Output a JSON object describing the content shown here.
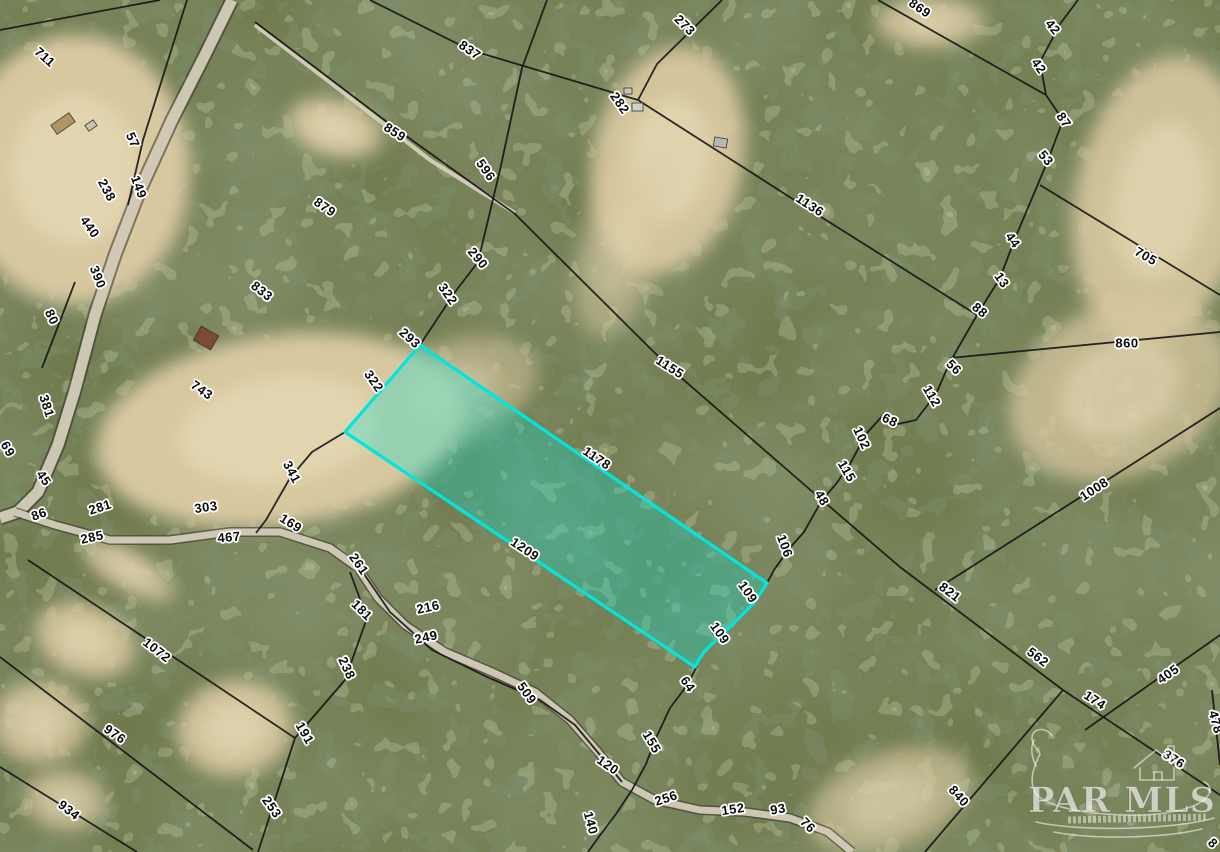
{
  "map": {
    "width": 1220,
    "height": 852,
    "colors": {
      "base": "#6b7547",
      "boundary": "#151515",
      "road": "#d8d0bd",
      "road_casing": "#332f28",
      "clearing": "#d8c8a0",
      "clearing_light": "#e6dab6",
      "parcel_stroke": "#00e6de",
      "parcel_fill": "rgba(0,230,214,0.30)",
      "label_halo": "#ffffff"
    },
    "watermark": {
      "title": "PAR MLS"
    },
    "parcel": {
      "points": [
        [
          420,
          345
        ],
        [
          767,
          583
        ],
        [
          754,
          603
        ],
        [
          733,
          624
        ],
        [
          716,
          640
        ],
        [
          704,
          652
        ],
        [
          698,
          661
        ],
        [
          695,
          667
        ],
        [
          345,
          432
        ]
      ]
    },
    "labels": [
      {
        "t": "711",
        "x": 45,
        "y": 57,
        "r": 42
      },
      {
        "t": "57",
        "x": 133,
        "y": 140,
        "r": 65
      },
      {
        "t": "149",
        "x": 139,
        "y": 187,
        "r": 70
      },
      {
        "t": "238",
        "x": 107,
        "y": 190,
        "r": 62
      },
      {
        "t": "440",
        "x": 90,
        "y": 227,
        "r": 55
      },
      {
        "t": "390",
        "x": 98,
        "y": 277,
        "r": 68
      },
      {
        "t": "80",
        "x": 52,
        "y": 317,
        "r": 65
      },
      {
        "t": "381",
        "x": 47,
        "y": 406,
        "r": 72
      },
      {
        "t": "69",
        "x": 8,
        "y": 449,
        "r": 60
      },
      {
        "t": "45",
        "x": 44,
        "y": 478,
        "r": 55
      },
      {
        "t": "86",
        "x": 39,
        "y": 514,
        "r": -20
      },
      {
        "t": "281",
        "x": 100,
        "y": 507,
        "r": -18
      },
      {
        "t": "285",
        "x": 92,
        "y": 537,
        "r": -12
      },
      {
        "t": "833",
        "x": 262,
        "y": 291,
        "r": 38
      },
      {
        "t": "743",
        "x": 202,
        "y": 390,
        "r": 35
      },
      {
        "t": "341",
        "x": 292,
        "y": 472,
        "r": 62
      },
      {
        "t": "303",
        "x": 206,
        "y": 507,
        "r": -8
      },
      {
        "t": "467",
        "x": 229,
        "y": 537,
        "r": -5
      },
      {
        "t": "169",
        "x": 291,
        "y": 523,
        "r": 32
      },
      {
        "t": "837",
        "x": 470,
        "y": 50,
        "r": 35
      },
      {
        "t": "859",
        "x": 395,
        "y": 132,
        "r": 33
      },
      {
        "t": "879",
        "x": 325,
        "y": 207,
        "r": 35
      },
      {
        "t": "596",
        "x": 486,
        "y": 170,
        "r": 55
      },
      {
        "t": "290",
        "x": 478,
        "y": 258,
        "r": 50
      },
      {
        "t": "322",
        "x": 448,
        "y": 294,
        "r": 55
      },
      {
        "t": "293",
        "x": 410,
        "y": 338,
        "r": 42
      },
      {
        "t": "322",
        "x": 374,
        "y": 381,
        "r": 55
      },
      {
        "t": "273",
        "x": 685,
        "y": 25,
        "r": 45
      },
      {
        "t": "282",
        "x": 620,
        "y": 103,
        "r": 55
      },
      {
        "t": "1136",
        "x": 810,
        "y": 205,
        "r": 33
      },
      {
        "t": "869",
        "x": 920,
        "y": 8,
        "r": 35
      },
      {
        "t": "42",
        "x": 1053,
        "y": 27,
        "r": 50
      },
      {
        "t": "42",
        "x": 1039,
        "y": 66,
        "r": 55
      },
      {
        "t": "87",
        "x": 1064,
        "y": 120,
        "r": 55
      },
      {
        "t": "53",
        "x": 1046,
        "y": 158,
        "r": 50
      },
      {
        "t": "44",
        "x": 1013,
        "y": 240,
        "r": 55
      },
      {
        "t": "13",
        "x": 1002,
        "y": 280,
        "r": 55
      },
      {
        "t": "88",
        "x": 980,
        "y": 310,
        "r": 40
      },
      {
        "t": "705",
        "x": 1146,
        "y": 256,
        "r": 30
      },
      {
        "t": "56",
        "x": 954,
        "y": 367,
        "r": 45
      },
      {
        "t": "112",
        "x": 932,
        "y": 396,
        "r": 60
      },
      {
        "t": "68",
        "x": 890,
        "y": 420,
        "r": 25
      },
      {
        "t": "102",
        "x": 862,
        "y": 438,
        "r": 65
      },
      {
        "t": "115",
        "x": 847,
        "y": 471,
        "r": 60
      },
      {
        "t": "48",
        "x": 822,
        "y": 498,
        "r": 60
      },
      {
        "t": "106",
        "x": 785,
        "y": 546,
        "r": 70
      },
      {
        "t": "1155",
        "x": 670,
        "y": 367,
        "r": 33
      },
      {
        "t": "1178",
        "x": 597,
        "y": 458,
        "r": 34
      },
      {
        "t": "860",
        "x": 1127,
        "y": 343,
        "r": 0
      },
      {
        "t": "1008",
        "x": 1094,
        "y": 489,
        "r": -33
      },
      {
        "t": "1209",
        "x": 525,
        "y": 549,
        "r": 34
      },
      {
        "t": "109",
        "x": 748,
        "y": 592,
        "r": 55
      },
      {
        "t": "109",
        "x": 720,
        "y": 633,
        "r": 55
      },
      {
        "t": "64",
        "x": 688,
        "y": 684,
        "r": 55
      },
      {
        "t": "155",
        "x": 652,
        "y": 742,
        "r": 60
      },
      {
        "t": "261",
        "x": 359,
        "y": 564,
        "r": 55
      },
      {
        "t": "181",
        "x": 362,
        "y": 610,
        "r": 45
      },
      {
        "t": "216",
        "x": 428,
        "y": 607,
        "r": -12
      },
      {
        "t": "249",
        "x": 426,
        "y": 637,
        "r": -12
      },
      {
        "t": "238",
        "x": 347,
        "y": 668,
        "r": 65
      },
      {
        "t": "509",
        "x": 527,
        "y": 693,
        "r": 55
      },
      {
        "t": "191",
        "x": 305,
        "y": 733,
        "r": 60
      },
      {
        "t": "253",
        "x": 272,
        "y": 807,
        "r": 55
      },
      {
        "t": "1072",
        "x": 157,
        "y": 650,
        "r": 38
      },
      {
        "t": "976",
        "x": 115,
        "y": 734,
        "r": 35
      },
      {
        "t": "934",
        "x": 69,
        "y": 810,
        "r": 38
      },
      {
        "t": "120",
        "x": 608,
        "y": 765,
        "r": 35
      },
      {
        "t": "140",
        "x": 591,
        "y": 823,
        "r": 75
      },
      {
        "t": "256",
        "x": 666,
        "y": 798,
        "r": -18
      },
      {
        "t": "152",
        "x": 733,
        "y": 809,
        "r": -8
      },
      {
        "t": "93",
        "x": 778,
        "y": 809,
        "r": -10
      },
      {
        "t": "76",
        "x": 808,
        "y": 825,
        "r": 45
      },
      {
        "t": "821",
        "x": 950,
        "y": 592,
        "r": 37
      },
      {
        "t": "562",
        "x": 1038,
        "y": 657,
        "r": 37
      },
      {
        "t": "174",
        "x": 1095,
        "y": 700,
        "r": 33
      },
      {
        "t": "405",
        "x": 1168,
        "y": 674,
        "r": -35
      },
      {
        "t": "478",
        "x": 1216,
        "y": 722,
        "r": 75
      },
      {
        "t": "376",
        "x": 1174,
        "y": 759,
        "r": 33
      },
      {
        "t": "840",
        "x": 959,
        "y": 796,
        "r": 48
      },
      {
        "t": "8",
        "x": 1213,
        "y": 843,
        "r": 45
      }
    ],
    "boundary_lines": [
      [
        [
          0,
          30
        ],
        [
          160,
          0
        ]
      ],
      [
        [
          547,
          0
        ],
        [
          522,
          68
        ],
        [
          500,
          170
        ],
        [
          478,
          262
        ],
        [
          455,
          292
        ],
        [
          420,
          345
        ]
      ],
      [
        [
          722,
          0
        ],
        [
          657,
          64
        ],
        [
          638,
          100
        ]
      ],
      [
        [
          370,
          0
        ],
        [
          470,
          50
        ],
        [
          638,
          100
        ]
      ],
      [
        [
          638,
          100
        ],
        [
          810,
          210
        ],
        [
          977,
          315
        ]
      ],
      [
        [
          255,
          22
        ],
        [
          395,
          128
        ],
        [
          515,
          214
        ],
        [
          670,
          368
        ],
        [
          822,
          500
        ]
      ],
      [
        [
          878,
          0
        ],
        [
          1046,
          95
        ]
      ],
      [
        [
          1078,
          0
        ],
        [
          1060,
          24
        ],
        [
          1040,
          62
        ],
        [
          1046,
          95
        ],
        [
          1063,
          120
        ],
        [
          1048,
          160
        ],
        [
          1038,
          184
        ],
        [
          1016,
          236
        ],
        [
          1000,
          278
        ],
        [
          977,
          315
        ],
        [
          950,
          362
        ],
        [
          936,
          394
        ],
        [
          916,
          420
        ],
        [
          898,
          424
        ],
        [
          884,
          414
        ],
        [
          866,
          434
        ],
        [
          850,
          464
        ],
        [
          836,
          484
        ],
        [
          822,
          500
        ],
        [
          804,
          532
        ],
        [
          788,
          550
        ],
        [
          774,
          570
        ],
        [
          767,
          583
        ]
      ],
      [
        [
          697,
          666
        ],
        [
          688,
          684
        ],
        [
          670,
          708
        ],
        [
          656,
          738
        ],
        [
          646,
          764
        ],
        [
          632,
          790
        ],
        [
          616,
          814
        ],
        [
          598,
          838
        ],
        [
          588,
          852
        ]
      ],
      [
        [
          822,
          500
        ],
        [
          900,
          567
        ],
        [
          1063,
          690
        ],
        [
          1220,
          795
        ]
      ],
      [
        [
          935,
          590
        ],
        [
          1220,
          408
        ]
      ],
      [
        [
          950,
          358
        ],
        [
          1220,
          332
        ]
      ],
      [
        [
          1085,
          730
        ],
        [
          1230,
          628
        ]
      ],
      [
        [
          1212,
          690
        ],
        [
          1220,
          765
        ]
      ],
      [
        [
          1063,
          690
        ],
        [
          925,
          852
        ]
      ],
      [
        [
          1040,
          185
        ],
        [
          1220,
          295
        ]
      ],
      [
        [
          345,
          432
        ],
        [
          312,
          452
        ],
        [
          290,
          478
        ],
        [
          266,
          520
        ],
        [
          256,
          533
        ]
      ],
      [
        [
          28,
          560
        ],
        [
          295,
          738
        ],
        [
          258,
          852
        ]
      ],
      [
        [
          0,
          657
        ],
        [
          253,
          850
        ]
      ],
      [
        [
          0,
          767
        ],
        [
          137,
          852
        ]
      ],
      [
        [
          350,
          572
        ],
        [
          367,
          618
        ],
        [
          345,
          680
        ],
        [
          295,
          738
        ]
      ],
      [
        [
          187,
          0
        ],
        [
          143,
          140
        ],
        [
          128,
          205
        ]
      ],
      [
        [
          75,
          282
        ],
        [
          42,
          368
        ]
      ],
      [
        [
          360,
          568
        ],
        [
          390,
          612
        ],
        [
          432,
          650
        ],
        [
          485,
          676
        ],
        [
          540,
          700
        ],
        [
          575,
          725
        ],
        [
          600,
          755
        ],
        [
          622,
          782
        ]
      ]
    ],
    "roads": [
      {
        "p": [
          [
            232,
            0
          ],
          [
            205,
            55
          ],
          [
            172,
            120
          ],
          [
            140,
            190
          ],
          [
            115,
            255
          ],
          [
            95,
            315
          ],
          [
            75,
            390
          ],
          [
            58,
            445
          ],
          [
            38,
            492
          ],
          [
            18,
            512
          ],
          [
            0,
            518
          ]
        ],
        "w": 11,
        "cw": 15
      },
      {
        "p": [
          [
            15,
            512
          ],
          [
            55,
            525
          ],
          [
            110,
            540
          ],
          [
            170,
            540
          ],
          [
            230,
            532
          ],
          [
            280,
            532
          ],
          [
            330,
            548
          ],
          [
            358,
            568
          ],
          [
            378,
            598
          ],
          [
            405,
            625
          ],
          [
            445,
            652
          ],
          [
            492,
            672
          ],
          [
            535,
            692
          ],
          [
            570,
            720
          ],
          [
            598,
            752
          ],
          [
            622,
            782
          ],
          [
            655,
            800
          ],
          [
            700,
            810
          ],
          [
            745,
            812
          ],
          [
            790,
            818
          ],
          [
            828,
            832
          ],
          [
            852,
            852
          ]
        ],
        "w": 7,
        "cw": 10
      },
      {
        "p": [
          [
            255,
            25
          ],
          [
            340,
            90
          ],
          [
            430,
            160
          ],
          [
            515,
            213
          ]
        ],
        "w": 4,
        "cw": 0
      }
    ],
    "clearings": [
      [
        75,
        170,
        115,
        135,
        0,
        1
      ],
      [
        335,
        128,
        48,
        28,
        15,
        0.9
      ],
      [
        668,
        160,
        75,
        115,
        12,
        0.95
      ],
      [
        280,
        430,
        185,
        95,
        -8,
        1
      ],
      [
        455,
        390,
        85,
        50,
        -18,
        0.55
      ],
      [
        1160,
        200,
        85,
        145,
        10,
        0.9
      ],
      [
        1120,
        390,
        115,
        85,
        -25,
        0.75
      ],
      [
        930,
        22,
        55,
        26,
        0,
        0.8
      ],
      [
        85,
        640,
        52,
        36,
        20,
        0.85
      ],
      [
        40,
        722,
        48,
        42,
        0,
        0.8
      ],
      [
        65,
        800,
        42,
        30,
        10,
        0.7
      ],
      [
        235,
        728,
        58,
        48,
        -10,
        0.9
      ],
      [
        128,
        570,
        52,
        20,
        30,
        0.8
      ],
      [
        890,
        800,
        85,
        48,
        -20,
        0.65
      ],
      [
        620,
        250,
        40,
        90,
        15,
        0.5
      ]
    ],
    "buildings": [
      [
        196,
        330,
        20,
        16,
        "#7d4a33",
        30
      ],
      [
        52,
        118,
        22,
        11,
        "#b09468",
        -35
      ],
      [
        86,
        122,
        10,
        7,
        "#c8c2b2",
        -35
      ],
      [
        632,
        103,
        11,
        8,
        "#cdd2d3",
        0
      ],
      [
        714,
        138,
        13,
        9,
        "#b4b8b2",
        10
      ],
      [
        624,
        88,
        8,
        6,
        "#c2c6c6",
        0
      ]
    ]
  }
}
